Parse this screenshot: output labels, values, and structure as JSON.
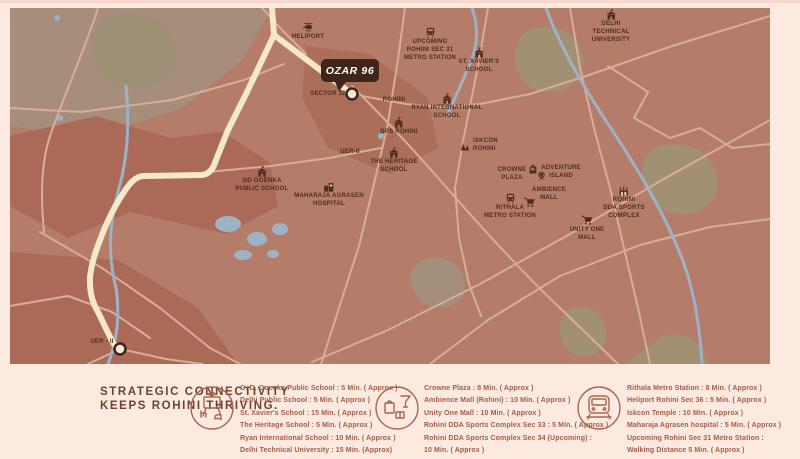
{
  "map": {
    "project_badge": "OZAR 96",
    "labels": {
      "heliport": "HELIPORT",
      "upcoming_metro": "UPCOMING\nROHINI SEC 31\nMETRO STATION",
      "delhi_tech": "DELHI\nTECHNICAL\nUNIVERSITY",
      "st_xaviers": "ST. XAVIER'S\nSCHOOL",
      "sector_32": "SECTOR 32",
      "rohini": "ROHINI",
      "ryan": "RYAN INTERNATIONAL\nSCHOOL",
      "dps": "DPS ROHINI",
      "iskcon": "ISKCON\nROHINI",
      "uer2": "UER-II",
      "heritage": "THE HERITAGE\nSCHOOL",
      "goenka": "GD GOENKA\nPUBLIC SCHOOL",
      "maharaja": "MAHARAJA AGRASEN\nHOSPITAL",
      "crowne": "CROWNE\nPLAZA",
      "adventure": "ADVENTURE\nISLAND",
      "ambience": "AMBIENCE\nMALL",
      "rithala": "RITHALA\nMETRO STATION",
      "dda": "ROHINI\nDDA SPORTS\nCOMPLEX",
      "unity": "UNITY ONE\nMALL",
      "uer2_south": "UER - II"
    }
  },
  "footer": {
    "heading": "STRATEGIC CONNECTIVITY\nKEEPS ROHINI THRIVING.",
    "columns": [
      {
        "icon": "education-doodle",
        "items": [
          "G. D. Goenka Public School : 5 Min. ( Approx )",
          "Delhi Public School : 5 Min. ( Approx )",
          "St. Xavier's School : 15 Min. ( Approx )",
          "The Heritage School : 5 Min. ( Approx )",
          "Ryan International School : 10 Min. ( Approx )",
          "Delhi Technical University : 15 Min. (Approx)"
        ]
      },
      {
        "icon": "leisure-doodle",
        "items": [
          "Crowne Plaza : 8 Min. ( Approx )",
          "Ambience Mall (Rohini) : 10 Min. ( Approx )",
          "Unity One Mall : 10 Min. ( Approx )",
          "Rohini DDA Sports Complex Sec 33 : 5 Min. ( Approx )",
          "Rohini DDA Sports Complex Sec 34 (Upcoming) :",
          "10 Min. ( Approx )"
        ]
      },
      {
        "icon": "transit-doodle",
        "items": [
          "Rithala Metro Station : 8 Min. ( Approx )",
          "Heliport Rohini Sec 36 : 5 Min. ( Approx )",
          "Iskcon Temple : 10 Min. ( Approx )",
          "Maharaja Agrasen hospital :  5 Min. ( Approx )",
          "Upcoming Rohini Sec 31 Metro Station :",
          "Walking Distance 5 Min. ( Approx )"
        ]
      }
    ]
  },
  "colors": {
    "page_cream": "#fce9df",
    "map_base": "#b57c6a",
    "map_dark_patch": "#aa6a57",
    "map_olive_patch": "#a19072",
    "road": "#d9ad99",
    "highway_cream": "#f4e9c6",
    "water": "#9db2c4",
    "label_dark": "#4e2d1f",
    "badge_bg": "#40251a",
    "heading_text": "#6e4233",
    "list_text": "#a25d49"
  }
}
